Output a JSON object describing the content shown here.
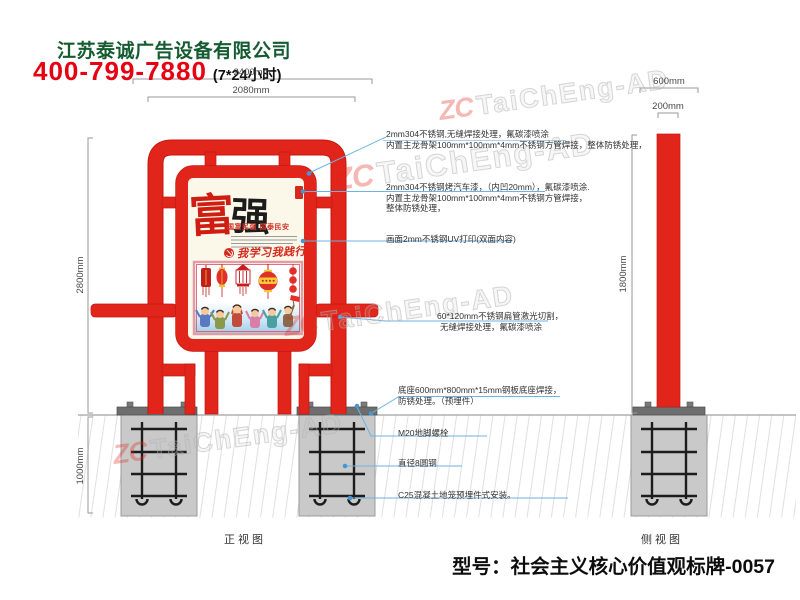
{
  "header": {
    "company": "江苏泰诚广告设备有限公司",
    "phone": "400-799-7880",
    "hours": "(7*24小时)"
  },
  "watermark": {
    "logo": "ZC",
    "text": "TaiChEng-AD"
  },
  "dimensions": {
    "front_overall_width": "2400mm",
    "front_frame_width": "2080mm",
    "front_height": "2800mm",
    "foundation_depth": "1000mm",
    "side_base_width": "600mm",
    "side_pole_width": "200mm",
    "side_height": "1800mm"
  },
  "annotations": [
    {
      "lines": [
        "2mm304不锈钢,无缝焊接处理，氟碳漆喷涂",
        "内置主龙骨架100mm*100mm*4mm不锈钢方管焊接，整体防锈处理，"
      ]
    },
    {
      "lines": [
        "2mm304不锈钢烤汽车漆，（内凹20mm），氟碳漆喷涂.",
        "内置主龙骨架100mm*100mm*4mm不锈钢方管焊接，",
        "整体防锈处理，"
      ]
    },
    {
      "lines": [
        "画面2mm不锈钢UV打印(双面内容)"
      ]
    },
    {
      "lines": [
        "60*120mm不锈钢扁管激光切割，",
        "无缝焊接处理，氟碳漆喷涂"
      ]
    },
    {
      "lines": [
        "底座600mm*800mm*15mm钢板底座焊接，",
        "防锈处理。（预埋件）"
      ]
    },
    {
      "lines": [
        "M20地脚螺栓"
      ]
    },
    {
      "lines": [
        "直径8圆钢"
      ]
    },
    {
      "lines": [
        "C25混凝土地笼预埋件式安装。"
      ]
    }
  ],
  "poster": {
    "char_left": "富",
    "char_right": "强",
    "subtitle": "国富民强 国泰民安",
    "slogan": "我学习我践行"
  },
  "views": {
    "front": "正视图",
    "side": "侧视图"
  },
  "footer": {
    "model": "型号：社会主义核心价值观标牌-0057"
  },
  "colors": {
    "accent_red": "#e2251b",
    "brand_green": "#155b31",
    "phone_red": "#e60012",
    "leader_blue": "#6db3e3",
    "concrete_gray": "#c9c9c9"
  }
}
